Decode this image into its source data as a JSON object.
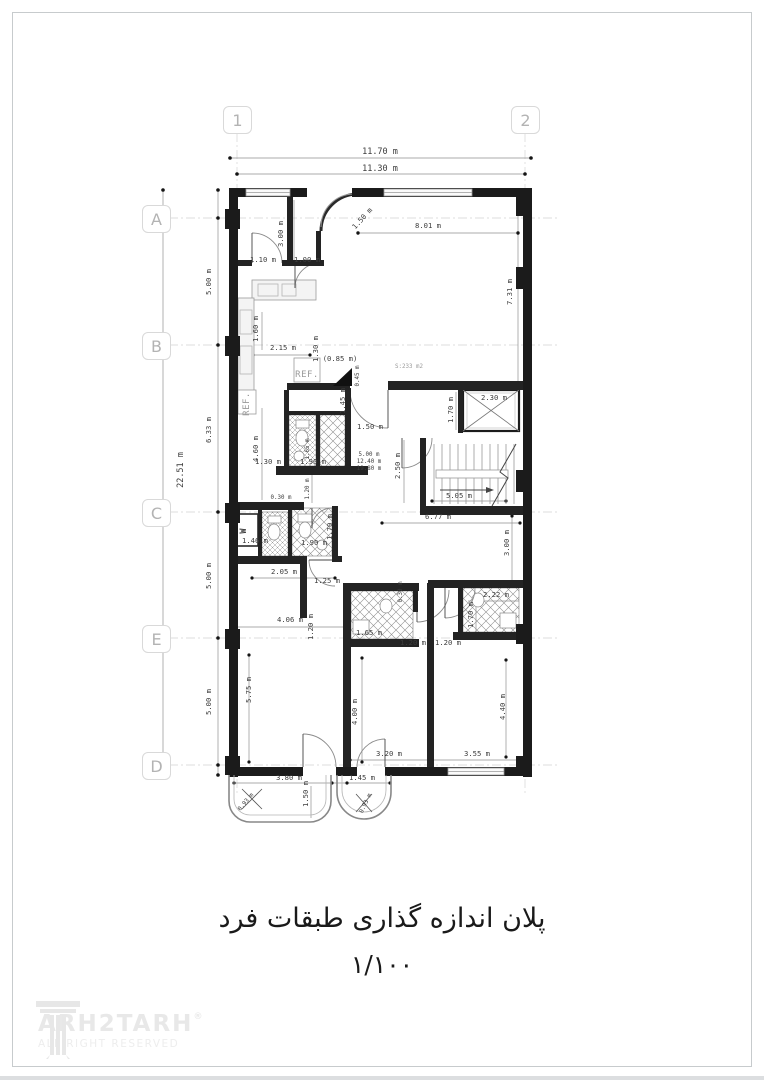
{
  "title": {
    "plan_fa": "پلان  اندازه گذاری طبقات فرد",
    "scale_fa": "۱/۱۰۰"
  },
  "branding": {
    "logo_text": "ARH2TARH",
    "registered": "®",
    "tagline": "ALL RIGHT RESERVED"
  },
  "grid": {
    "columns": [
      {
        "label": "1"
      },
      {
        "label": "2"
      }
    ],
    "rows": [
      {
        "label": "A"
      },
      {
        "label": "B"
      },
      {
        "label": "C"
      },
      {
        "label": "E"
      },
      {
        "label": "D"
      }
    ]
  },
  "overall_dimensions": {
    "width_outer": "11.70 m",
    "width_inner": "11.30 m",
    "height_outer": "22.51 m"
  },
  "annotations": [
    {
      "text": "11.70 m",
      "x": 380,
      "y": 154,
      "cls": "dim"
    },
    {
      "text": "11.30 m",
      "x": 380,
      "y": 171,
      "cls": "dim"
    },
    {
      "text": "22.51 m",
      "x": 183,
      "y": 470,
      "rot": -90,
      "cls": "dim"
    },
    {
      "text": "5.00 m",
      "x": 211,
      "y": 282,
      "rot": -90,
      "cls": "sm"
    },
    {
      "text": "6.33 m",
      "x": 211,
      "y": 430,
      "rot": -90,
      "cls": "sm"
    },
    {
      "text": "5.00 m",
      "x": 211,
      "y": 576,
      "rot": -90,
      "cls": "sm"
    },
    {
      "text": "5.00 m",
      "x": 211,
      "y": 702,
      "rot": -90,
      "cls": "sm"
    },
    {
      "text": "3.00 m",
      "x": 283,
      "y": 234,
      "rot": -90,
      "cls": "sm"
    },
    {
      "text": "1.50 m",
      "x": 364,
      "y": 220,
      "rot": -48,
      "cls": "sm"
    },
    {
      "text": "8.01 m",
      "x": 428,
      "y": 228,
      "cls": "sm"
    },
    {
      "text": "7.31 m",
      "x": 512,
      "y": 292,
      "rot": -90,
      "cls": "sm"
    },
    {
      "text": "1.10 m",
      "x": 263,
      "y": 262,
      "cls": "sm"
    },
    {
      "text": "1.00 m",
      "x": 307,
      "y": 262,
      "cls": "sm"
    },
    {
      "text": "2.15 m",
      "x": 283,
      "y": 350,
      "cls": "sm"
    },
    {
      "text": "1.60 m",
      "x": 258,
      "y": 329,
      "rot": -90,
      "cls": "sm"
    },
    {
      "text": "1.30 m",
      "x": 318,
      "y": 349,
      "rot": -90,
      "cls": "sm"
    },
    {
      "text": "(0.85 m)",
      "x": 340,
      "y": 361,
      "cls": "sm"
    },
    {
      "text": "0.45 m",
      "x": 359,
      "y": 376,
      "rot": -90,
      "cls": "xs"
    },
    {
      "text": "1.45 m",
      "x": 345,
      "y": 401,
      "rot": -90,
      "cls": "sm"
    },
    {
      "text": "1.50 m",
      "x": 370,
      "y": 429,
      "cls": "sm"
    },
    {
      "text": "2.30 m",
      "x": 494,
      "y": 400,
      "cls": "sm"
    },
    {
      "text": "1.70 m",
      "x": 453,
      "y": 410,
      "rot": -90,
      "cls": "sm"
    },
    {
      "text": "4.60 m",
      "x": 258,
      "y": 449,
      "rot": -90,
      "cls": "sm"
    },
    {
      "text": "1.30 m",
      "x": 268,
      "y": 464,
      "cls": "sm"
    },
    {
      "text": "1.90 m",
      "x": 313,
      "y": 464,
      "cls": "sm"
    },
    {
      "text": "1.65 m",
      "x": 309,
      "y": 449,
      "rot": -90,
      "cls": "xs"
    },
    {
      "text": "5.00 m",
      "x": 369,
      "y": 456,
      "cls": "xs"
    },
    {
      "text": "12.40 m",
      "x": 369,
      "y": 463,
      "cls": "xs"
    },
    {
      "text": "19.80 m",
      "x": 369,
      "y": 470,
      "cls": "xs"
    },
    {
      "text": "2.50 m",
      "x": 400,
      "y": 466,
      "rot": -90,
      "cls": "sm"
    },
    {
      "text": "1.20 m",
      "x": 309,
      "y": 489,
      "rot": -90,
      "cls": "xs"
    },
    {
      "text": "5.05 m",
      "x": 459,
      "y": 498,
      "cls": "sm"
    },
    {
      "text": "6.77 m",
      "x": 438,
      "y": 519,
      "cls": "sm"
    },
    {
      "text": "S:233 m2",
      "x": 409,
      "y": 368,
      "cls": "xs gray"
    },
    {
      "text": "REF.",
      "x": 307,
      "y": 377,
      "cls": "ref"
    },
    {
      "text": "REF.",
      "x": 249,
      "y": 404,
      "rot": -90,
      "cls": "ref"
    },
    {
      "text": "0.30 m",
      "x": 281,
      "y": 499,
      "cls": "xs"
    },
    {
      "text": "W",
      "x": 246,
      "y": 531,
      "rot": -90,
      "cls": "w"
    },
    {
      "text": "1.46 m",
      "x": 255,
      "y": 543,
      "cls": "sm"
    },
    {
      "text": "1.90 m",
      "x": 314,
      "y": 545,
      "cls": "sm"
    },
    {
      "text": "1.70 m",
      "x": 332,
      "y": 527,
      "rot": -90,
      "cls": "sm"
    },
    {
      "text": "2.05 m",
      "x": 284,
      "y": 574,
      "cls": "sm"
    },
    {
      "text": "1.25 m",
      "x": 327,
      "y": 583,
      "cls": "sm"
    },
    {
      "text": "1.20 m",
      "x": 313,
      "y": 627,
      "rot": -90,
      "cls": "sm"
    },
    {
      "text": "4.06 m",
      "x": 290,
      "y": 622,
      "cls": "sm"
    },
    {
      "text": "1.65 m",
      "x": 369,
      "y": 635,
      "cls": "sm"
    },
    {
      "text": "0.30 m",
      "x": 402,
      "y": 592,
      "rot": -90,
      "cls": "xs"
    },
    {
      "text": "1.20 m",
      "x": 413,
      "y": 645,
      "cls": "sm"
    },
    {
      "text": "1.20 m",
      "x": 448,
      "y": 645,
      "cls": "sm"
    },
    {
      "text": "2.22 m",
      "x": 496,
      "y": 597,
      "cls": "sm"
    },
    {
      "text": "1.70 m",
      "x": 473,
      "y": 615,
      "rot": -90,
      "cls": "sm"
    },
    {
      "text": "3.00 m",
      "x": 509,
      "y": 543,
      "rot": -90,
      "cls": "sm"
    },
    {
      "text": "5.75 m",
      "x": 251,
      "y": 690,
      "rot": -90,
      "cls": "sm"
    },
    {
      "text": "4.00 m",
      "x": 357,
      "y": 712,
      "rot": -90,
      "cls": "sm"
    },
    {
      "text": "4.40 m",
      "x": 505,
      "y": 707,
      "rot": -90,
      "cls": "sm"
    },
    {
      "text": "3.80 m",
      "x": 289,
      "y": 780,
      "cls": "sm"
    },
    {
      "text": "1.45 m",
      "x": 362,
      "y": 780,
      "cls": "sm"
    },
    {
      "text": "1.50 m",
      "x": 308,
      "y": 794,
      "rot": -90,
      "cls": "sm"
    },
    {
      "text": "3.20 m",
      "x": 389,
      "y": 756,
      "cls": "sm"
    },
    {
      "text": "3.55 m",
      "x": 477,
      "y": 756,
      "cls": "sm"
    },
    {
      "text": "0.93 m",
      "x": 247,
      "y": 803,
      "rot": -50,
      "cls": "xs"
    },
    {
      "text": "0.93 m",
      "x": 367,
      "y": 804,
      "rot": -65,
      "cls": "xs"
    }
  ]
}
